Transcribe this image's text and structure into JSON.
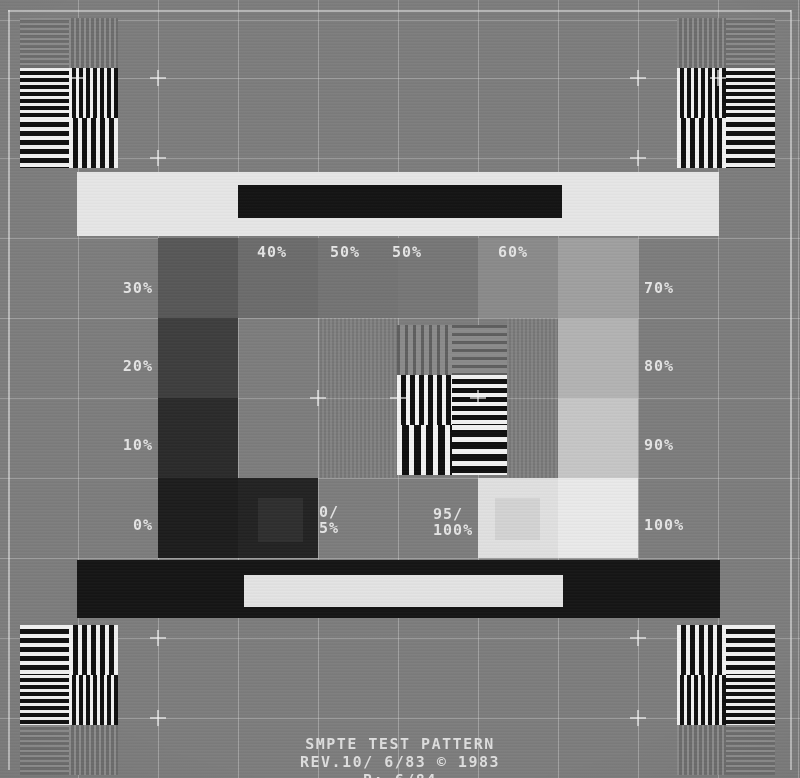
{
  "pattern": {
    "name": "SMPTE monochrome test pattern",
    "colors": {
      "background": "#7d7d7d",
      "grid_line": "rgba(232,232,232,0.34)",
      "frame_line": "rgba(238,238,238,0.52)",
      "label_text": "#e4e4e4",
      "footer_text": "#dedede",
      "grating_light": "#f1f1f1",
      "grating_dark": "#101010"
    },
    "icons": {
      "crosshair": "plus-crosshair-icon",
      "corner_blocks": "resolution-grating-block",
      "center_block": "resolution-grating-block"
    },
    "bars": {
      "top": {
        "bar_color": "#e6e6e6",
        "inner_color": "#141414"
      },
      "bottom": {
        "bar_color": "#151515",
        "inner_color": "#e3e3e3"
      }
    },
    "grayscale_patches": [
      {
        "name": "patch-30",
        "col": 0,
        "row": 0,
        "value": "30%",
        "shade": "#585858"
      },
      {
        "name": "patch-40",
        "col": 1,
        "row": 0,
        "value": "40%",
        "shade": "#6c6c6c"
      },
      {
        "name": "patch-50a",
        "col": 2,
        "row": 0,
        "value": "50%",
        "shade": "#747474"
      },
      {
        "name": "patch-50b",
        "col": 3,
        "row": 0,
        "value": "50%",
        "shade": "#777777"
      },
      {
        "name": "patch-60",
        "col": 4,
        "row": 0,
        "value": "60%",
        "shade": "#8b8b8b"
      },
      {
        "name": "patch-70",
        "col": 5,
        "row": 0,
        "value": "70%",
        "shade": "#a0a0a0"
      },
      {
        "name": "patch-20",
        "col": 0,
        "row": 1,
        "value": "20%",
        "shade": "#3e3e3e"
      },
      {
        "name": "patch-80",
        "col": 5,
        "row": 1,
        "value": "80%",
        "shade": "#b3b3b3"
      },
      {
        "name": "patch-10",
        "col": 0,
        "row": 2,
        "value": "10%",
        "shade": "#2b2b2b"
      },
      {
        "name": "patch-90",
        "col": 5,
        "row": 2,
        "value": "90%",
        "shade": "#c6c6c6"
      },
      {
        "name": "patch-0",
        "col": 0,
        "row": 3,
        "value": "0%",
        "shade": "#1d1d1d"
      },
      {
        "name": "patch-0-5",
        "col": 1,
        "row": 3,
        "value": "0/5%",
        "shade": "#232323",
        "inner": {
          "shade": "#2f2f2f",
          "dx": 20,
          "dy": 20,
          "w": 45,
          "h": 44
        }
      },
      {
        "name": "patch-95-100",
        "col": 4,
        "row": 3,
        "value": "95/100%",
        "shade": "#e0e0e0",
        "inner": {
          "shade": "#d3d3d3",
          "dx": 17,
          "dy": 20,
          "w": 45,
          "h": 42
        }
      },
      {
        "name": "patch-100",
        "col": 5,
        "row": 3,
        "value": "100%",
        "shade": "#eaeaea"
      }
    ],
    "labels": [
      {
        "name": "label-30",
        "text": "30%",
        "x": 103,
        "y": 280,
        "w": 50,
        "align": "right"
      },
      {
        "name": "label-20",
        "text": "20%",
        "x": 103,
        "y": 358,
        "w": 50,
        "align": "right"
      },
      {
        "name": "label-10",
        "text": "10%",
        "x": 103,
        "y": 437,
        "w": 50,
        "align": "right"
      },
      {
        "name": "label-0",
        "text": "0%",
        "x": 103,
        "y": 517,
        "w": 50,
        "align": "right"
      },
      {
        "name": "label-70",
        "text": "70%",
        "x": 644,
        "y": 280
      },
      {
        "name": "label-80",
        "text": "80%",
        "x": 644,
        "y": 358
      },
      {
        "name": "label-90",
        "text": "90%",
        "x": 644,
        "y": 437
      },
      {
        "name": "label-100",
        "text": "100%",
        "x": 644,
        "y": 517
      },
      {
        "name": "label-40",
        "text": "40%",
        "x": 257,
        "y": 244
      },
      {
        "name": "label-50a",
        "text": "50%",
        "x": 330,
        "y": 244
      },
      {
        "name": "label-50b",
        "text": "50%",
        "x": 392,
        "y": 244
      },
      {
        "name": "label-60",
        "text": "60%",
        "x": 498,
        "y": 244
      },
      {
        "name": "label-0-5",
        "lines": [
          "0/",
          "5%"
        ],
        "x": 319,
        "y": 504
      },
      {
        "name": "label-95-100",
        "lines": [
          "95/",
          "100%"
        ],
        "x": 433,
        "y": 506
      }
    ],
    "footer": {
      "lines": [
        "SMPTE TEST PATTERN",
        "REV.10/ 6/83 © 1983",
        "R: 6/84"
      ]
    }
  }
}
